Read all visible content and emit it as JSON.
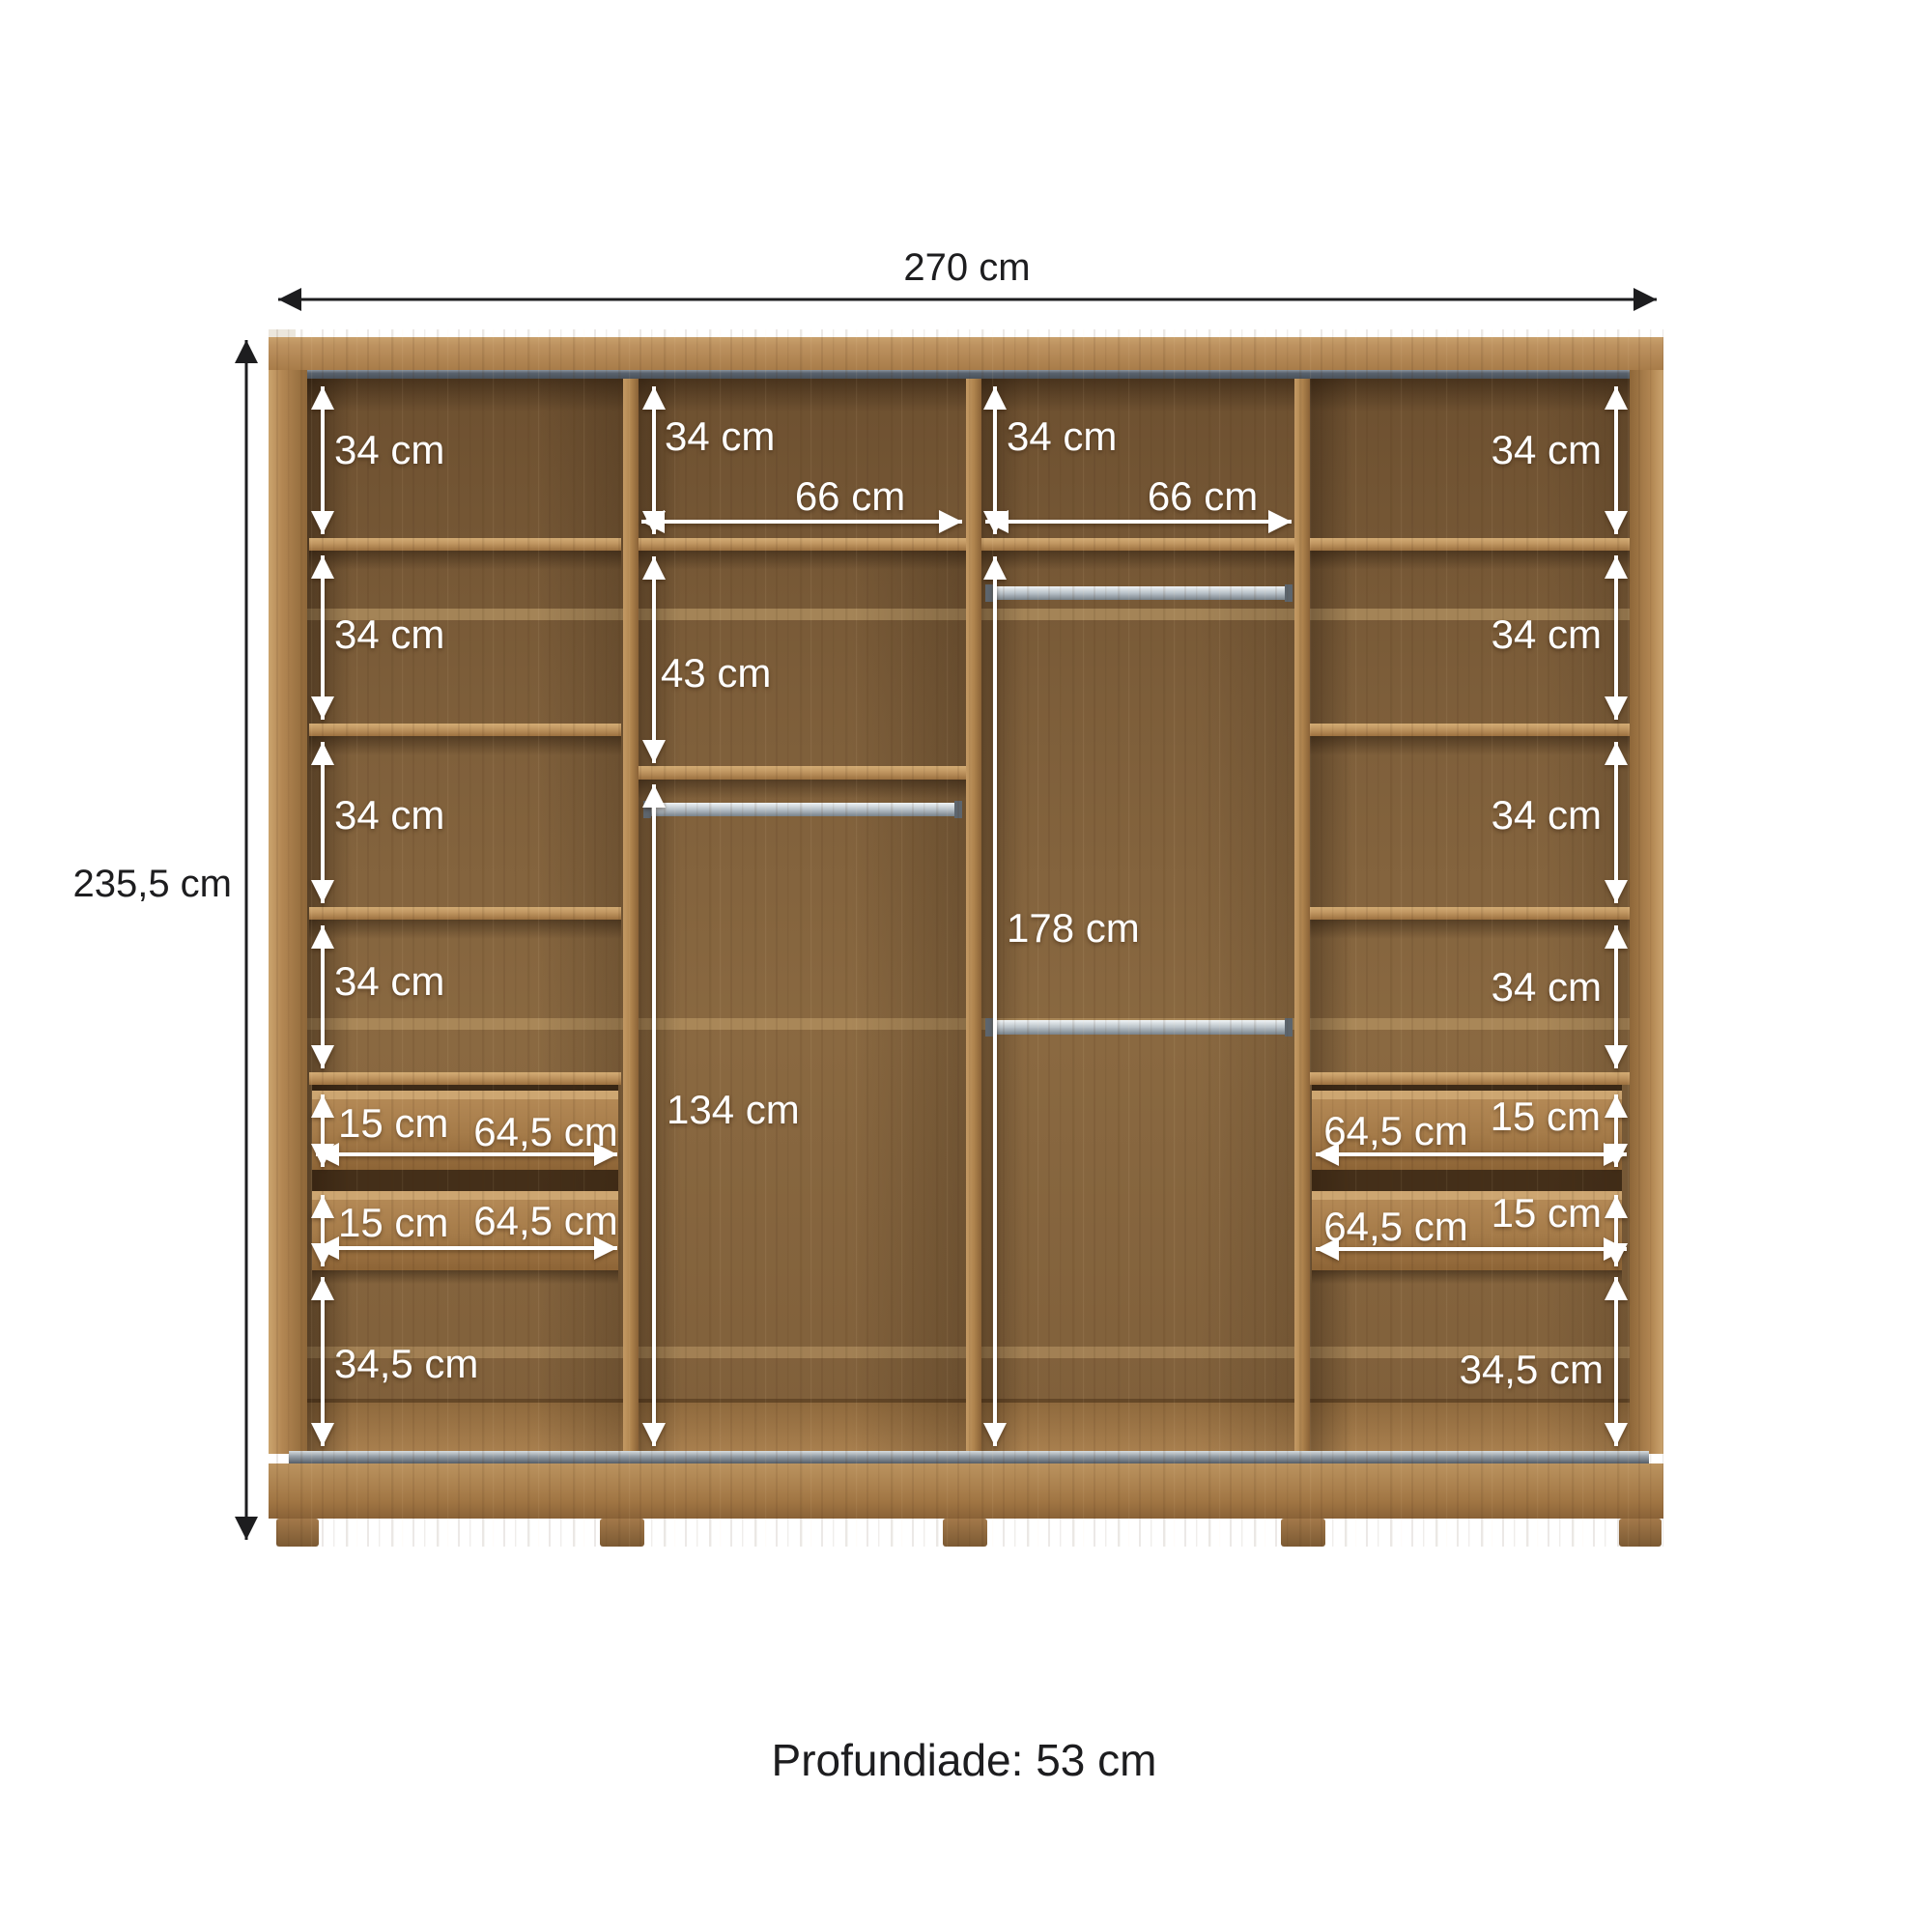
{
  "diagram": {
    "depth_note": "Profundiade: 53 cm",
    "overall": {
      "width": "270 cm",
      "height": "235,5 cm"
    },
    "columns": {
      "left": {
        "sections": [
          "34 cm",
          "34 cm",
          "34 cm",
          "34 cm"
        ],
        "drawers": [
          {
            "height": "15 cm",
            "width": "64,5 cm"
          },
          {
            "height": "15 cm",
            "width": "64,5 cm"
          }
        ],
        "bottom_section": "34,5 cm"
      },
      "center_left": {
        "top_section": "34 cm",
        "inner_width": "66 cm",
        "upper_section": "43 cm",
        "lower_section": "134 cm"
      },
      "center_right": {
        "top_section": "34 cm",
        "inner_width": "66 cm",
        "hanging_section": "178 cm"
      },
      "right": {
        "sections": [
          "34 cm",
          "34 cm",
          "34 cm",
          "34 cm"
        ],
        "drawers": [
          {
            "height": "15 cm",
            "width": "64,5 cm"
          },
          {
            "height": "15 cm",
            "width": "64,5 cm"
          }
        ],
        "bottom_section": "34,5 cm"
      }
    },
    "colors": {
      "background": "#ffffff",
      "wood_light": "#c79f6a",
      "wood_mid": "#ab8050",
      "wood_interior": "#7b5c38",
      "track_grey": "#5a636e",
      "chrome_rod": "#c3cbd2",
      "dimension_black": "#1d1d1f",
      "dimension_white": "#ffffff"
    }
  }
}
